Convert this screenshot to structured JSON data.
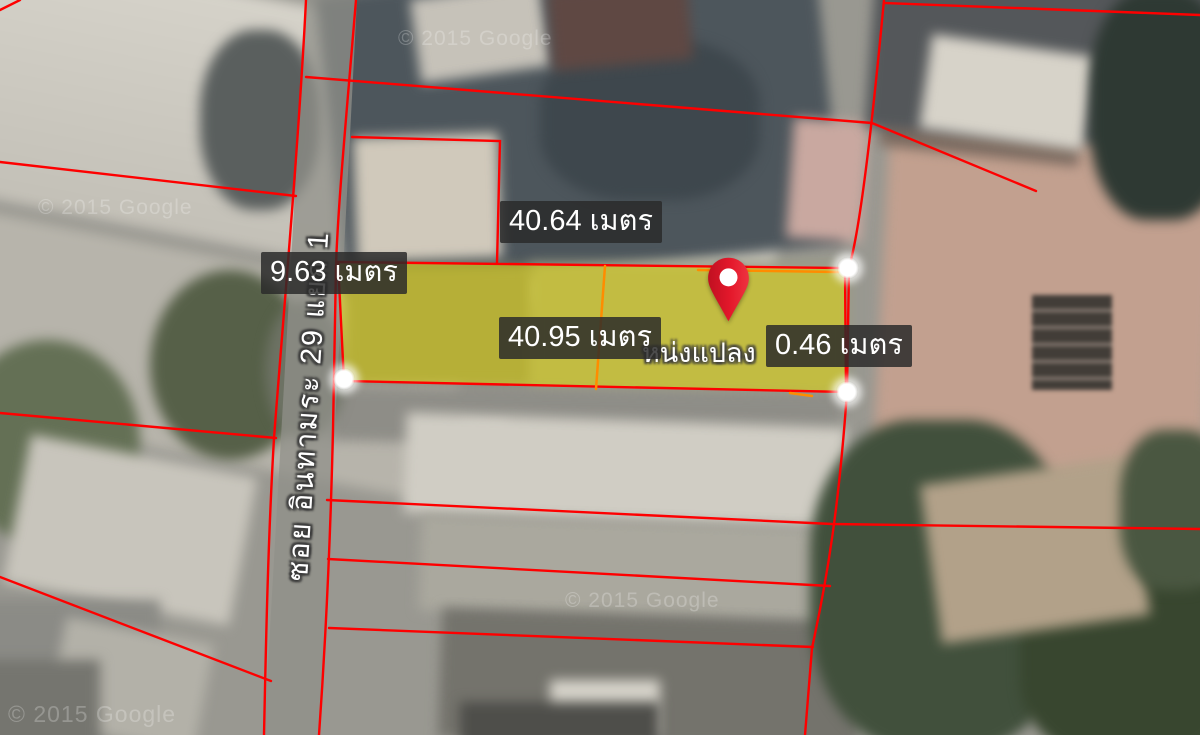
{
  "map": {
    "type": "satellite-cadastral-view",
    "watermarks": [
      "© 2015 Google",
      "© 2015 Google",
      "© 2015 Google",
      "© 2015 Google"
    ],
    "street": {
      "name": "ซอย อินทามระ 29 แยก 1"
    }
  },
  "measurements": {
    "top": "40.64 เมตร",
    "left": "9.63 เมตร",
    "middle": "40.95 เมตร",
    "right": "0.46 เมตร"
  },
  "parcel": {
    "location_label_fragment": "หน่งแปลง",
    "fill_color": "#e8dc00",
    "boundary_color": "#fe0000",
    "subdivision_color": "#ff8c00"
  },
  "marker": {
    "color": "#e4182b",
    "inner_dot_color": "#ffffff"
  }
}
